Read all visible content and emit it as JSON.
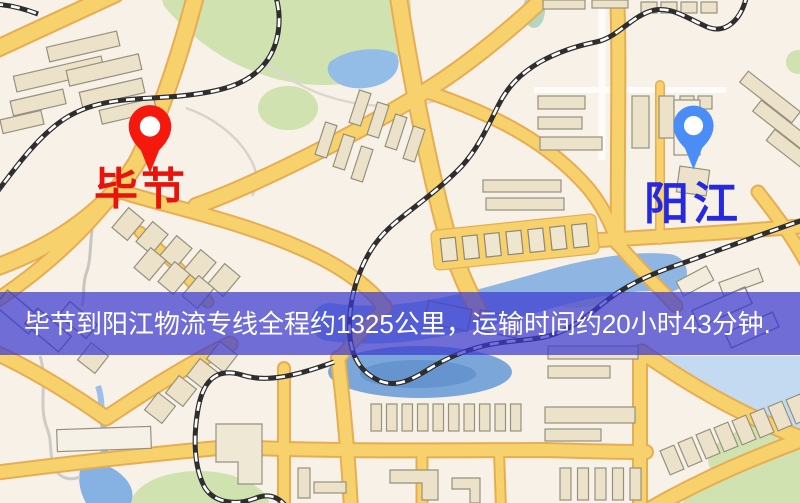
{
  "map": {
    "origin_label": "毕节",
    "destination_label": "阳江",
    "origin_pin_icon": "red-map-pin",
    "destination_pin_icon": "blue-map-pin"
  },
  "banner": {
    "text": "毕节到阳江物流专线全程约1325公里，运输时间约20小时43分钟.",
    "distance_km": 1325,
    "duration_hours": 20,
    "duration_minutes": 43
  },
  "colors": {
    "origin_label": "#e8130a",
    "destination_label": "#2629e0",
    "pin_red": "#f5190d",
    "pin_blue": "#4b8df6",
    "banner_bg": "#3b3ad0",
    "banner_opacity": 0.72,
    "banner_text": "#ffffff",
    "road_yellow": "#f6d16c",
    "road_casing": "#e7ad52",
    "water_blue": "#8fb6e2",
    "park_green": "#cfe2af",
    "building_fill": "#ebe2c9",
    "railway_dark": "#2e2e2e",
    "map_background": "#f7f1e8"
  }
}
